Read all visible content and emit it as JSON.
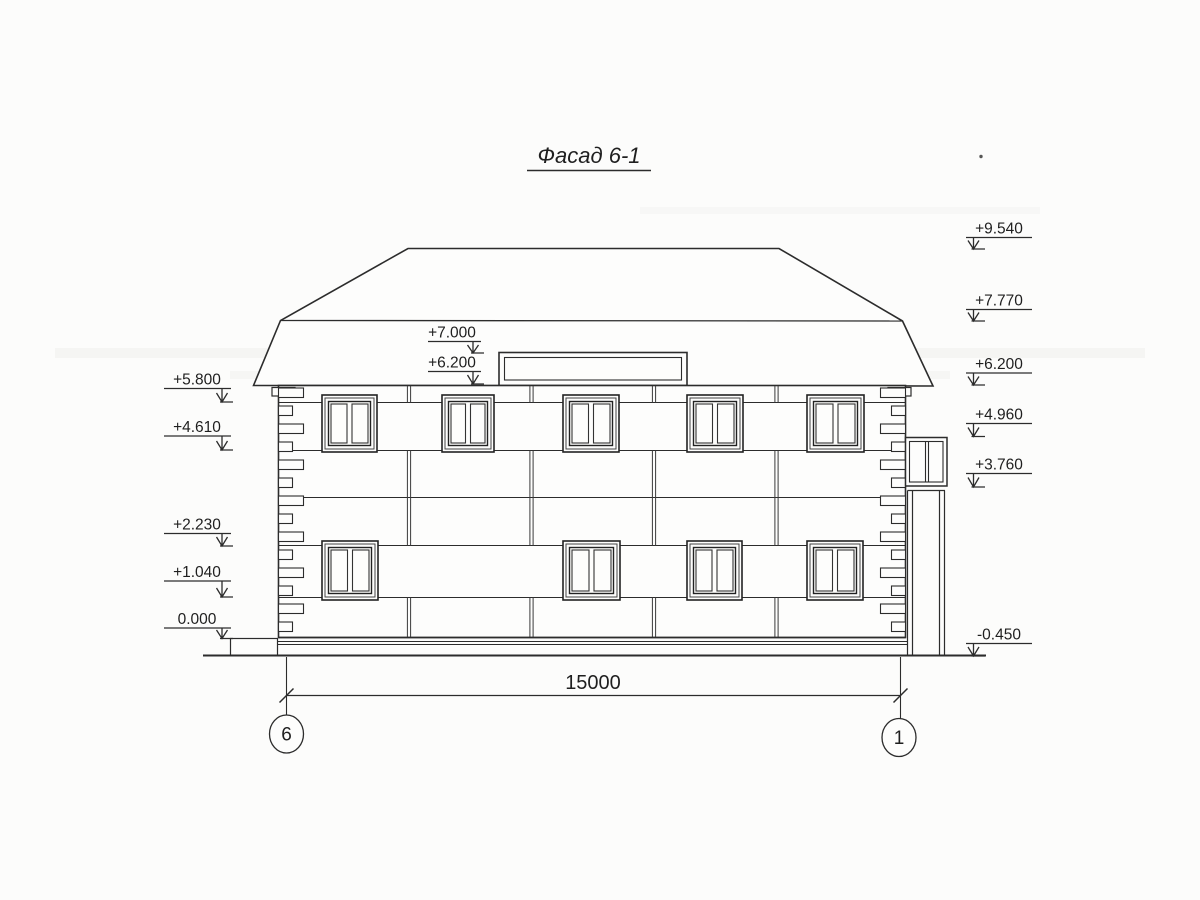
{
  "title": "Фасад 6-1",
  "drawing_type": "building facade elevation",
  "markers": {
    "left": [
      {
        "value": "+5.800"
      },
      {
        "value": "+4.610"
      },
      {
        "value": "+2.230"
      },
      {
        "value": "+1.040"
      },
      {
        "value": "0.000"
      }
    ],
    "center": [
      {
        "value": "+7.000"
      },
      {
        "value": "+6.200"
      }
    ],
    "right": [
      {
        "value": "+9.540"
      },
      {
        "value": "+7.770"
      },
      {
        "value": "+6.200"
      },
      {
        "value": "+4.960"
      },
      {
        "value": "+3.760"
      },
      {
        "value": "-0.450"
      }
    ]
  },
  "dimension": {
    "value": "15000"
  },
  "axes": [
    {
      "label": "6"
    },
    {
      "label": "1"
    }
  ],
  "colors": {
    "paper": "#fcfcfb",
    "line": "#2c2c2c"
  }
}
